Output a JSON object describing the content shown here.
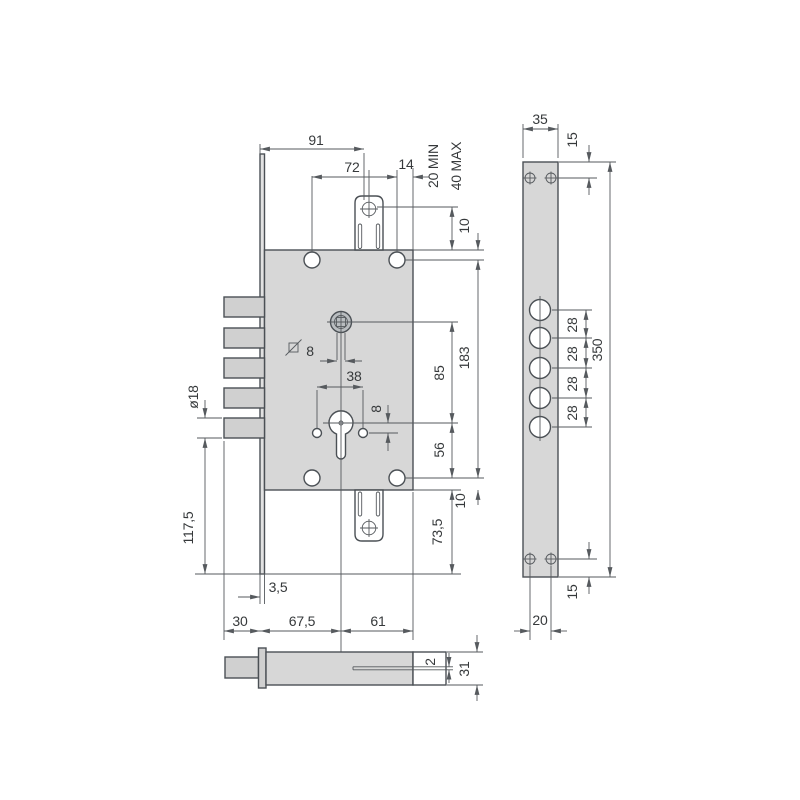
{
  "drawing": {
    "front": {
      "d91": "91",
      "d72": "72",
      "d14": "14",
      "d20min": "20 MIN",
      "d40max": "40 MAX",
      "d10top": "10",
      "sq8": "8",
      "d38": "38",
      "d8": "8",
      "d85": "85",
      "d183": "183",
      "d56": "56",
      "d10bottom": "10",
      "d73_5": "73,5",
      "d117_5": "117,5",
      "d18": "ø18",
      "d3_5": "3,5",
      "d30": "30",
      "d67_5": "67,5",
      "d61": "61"
    },
    "side": {
      "d35": "35",
      "d15top": "15",
      "spacing": [
        "28",
        "28",
        "28",
        "28"
      ],
      "d350": "350",
      "d15bottom": "15",
      "d20": "20"
    },
    "bottom": {
      "d2": "2",
      "d31": "31"
    }
  }
}
